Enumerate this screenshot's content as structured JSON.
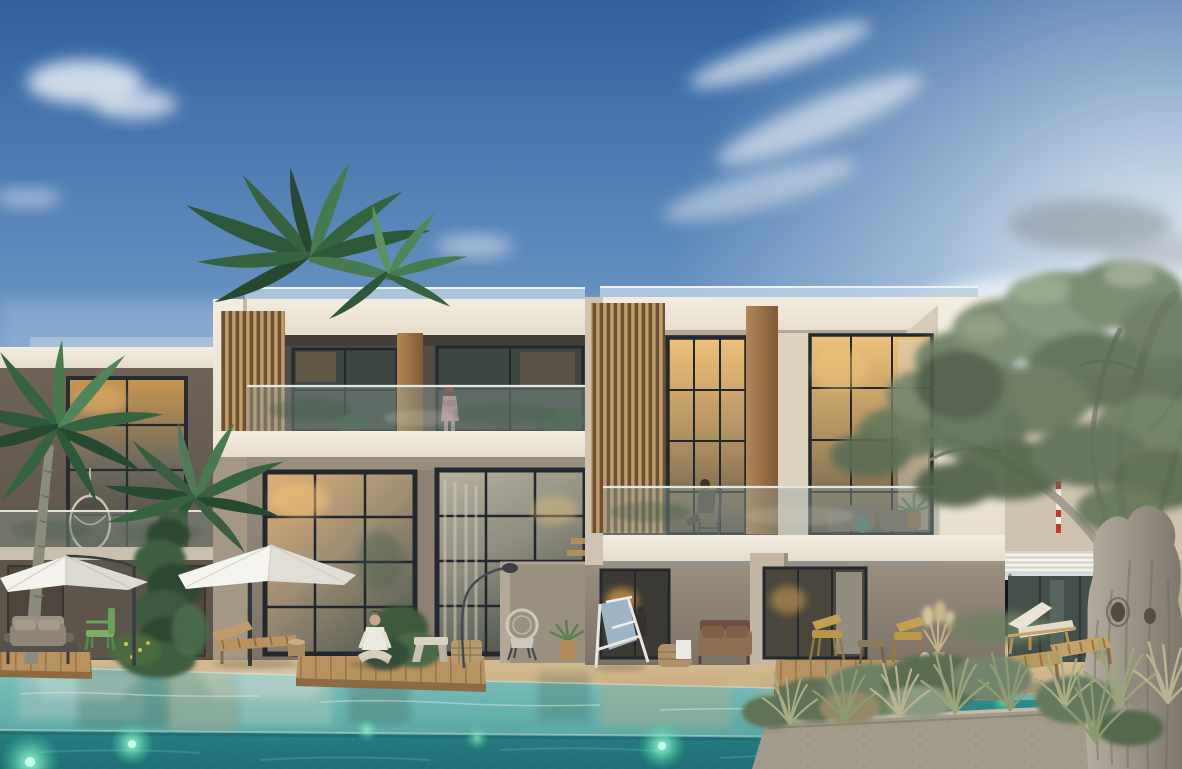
{
  "scene": {
    "type": "architectural_rendering",
    "subject": "modern-two-storey-resort-apartments-with-pool-at-dusk",
    "time_of_day": "dusk",
    "elements": {
      "buildings": [
        "far-left-wing",
        "left-block",
        "right-block",
        "far-right-building-with-pergola"
      ],
      "vegetation": [
        "rooftop-palm",
        "left-palm",
        "mid-palm",
        "ivy-column",
        "large-olive-tree",
        "planter-grasses",
        "shrubs"
      ],
      "water": "infinity-pool-with-underwater-lights",
      "umbrella_count": 2,
      "pool_light_count": 6,
      "figures": [
        "woman-standing-on-left-balcony",
        "person-seated-on-right-balcony",
        "person-seated-cross-legged-on-deck",
        "person-seated-inside-ground-window"
      ],
      "furniture": [
        "wicker-sofa",
        "green-chair",
        "wooden-loungers",
        "white-cushion-lounger",
        "blue-folding-deck-chair",
        "brown-patio-sofa",
        "yellow-wood-chairs",
        "concrete-bench",
        "wicker-cube",
        "floor-lamp",
        "hanging-egg-chair"
      ]
    }
  },
  "palette": {
    "sky_top": "#30619f",
    "sky_mid": "#6b94c2",
    "sky_horizon": "#c3d8ea",
    "sun_glow": "#f6fafc",
    "cloud_white": "#f2f5f8",
    "cloud_grey": "#97a1ab",
    "facade_cream": "#e6dccb",
    "facade_lit": "#f3ede0",
    "facade_shadow": "#c3b6a2",
    "recess_dark": "#524c45",
    "wood_slat_base": "#6b5134",
    "wood_slat_line": "#c49d6b",
    "window_frame": "#23282e",
    "glass_warm": "#dfb078",
    "glass_cool": "#6a7470",
    "interior_glow": "#eec17a",
    "railing_glass": "#93a29a",
    "wall_lower_lit": "#9a8e7e",
    "wall_lower_shade": "#7c7267",
    "deck_sand": "#d8c094",
    "deck_sand_shade": "#bb9f78",
    "deck_wood": "#b8935f",
    "water_top": "#7fc1bb",
    "water_mid": "#4a9c9e",
    "water_deep": "#1e6f76",
    "pool_glow": "#7df5c2",
    "planter_stone": "#a29a8b",
    "olive_leaf": "#6d7f63",
    "olive_leaf_light": "#93a585",
    "olive_trunk_lit": "#b5aea0",
    "olive_trunk_shade": "#7e776b",
    "palm_leaf": "#35633f",
    "palm_leaf_light": "#5d9160",
    "umbrella_white": "#f4f2ec",
    "figure_dress": "#bb8f98"
  }
}
